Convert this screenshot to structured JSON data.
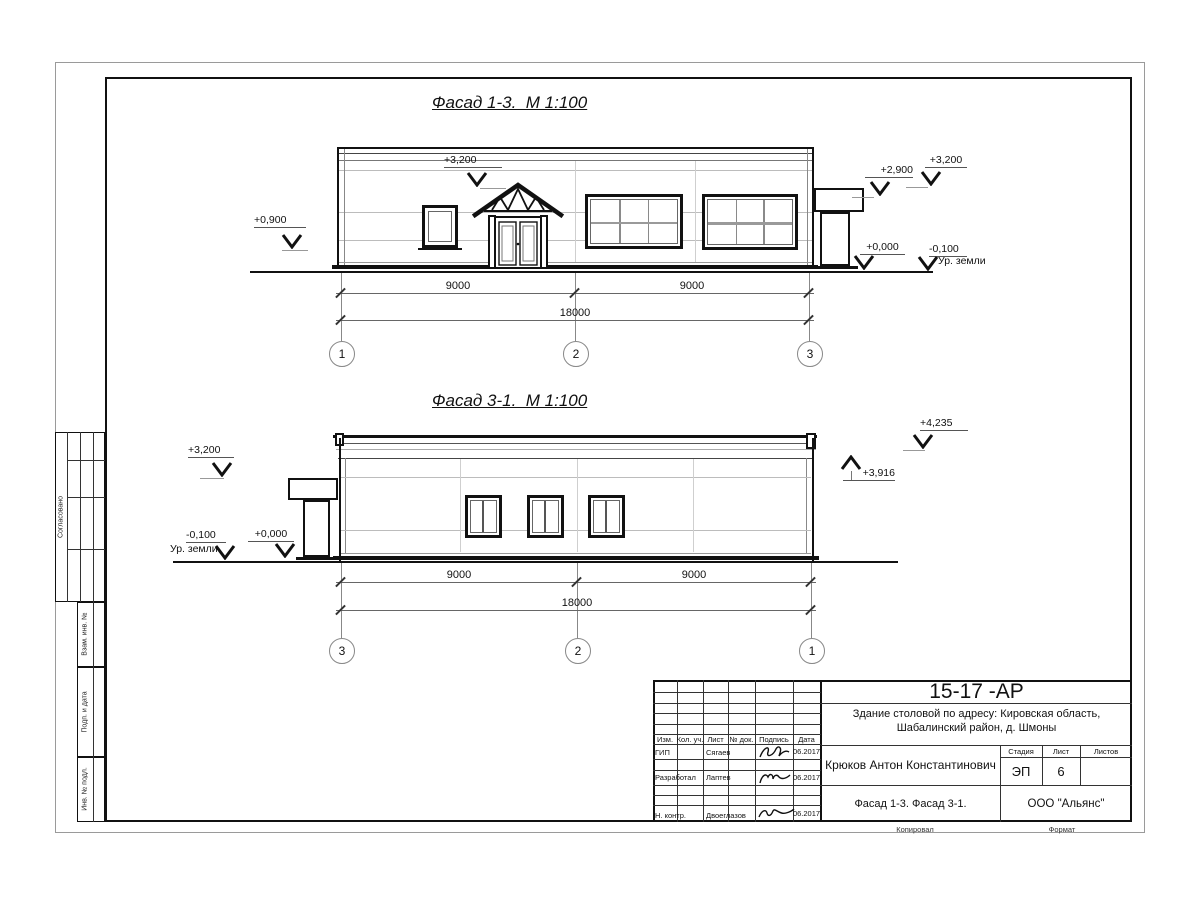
{
  "drawing1": {
    "title": "Фасад 1-3.  М 1:100",
    "marks": {
      "roof": "+3,200",
      "left_wall": "+0,900",
      "canopy": "+2,900",
      "right": "+3,200",
      "zero": "+0,000",
      "ground": "-0,100",
      "ground_label": "Ур. земли"
    },
    "dims": {
      "span1": "9000",
      "span2": "9000",
      "total": "18000"
    },
    "axes": [
      "1",
      "2",
      "3"
    ]
  },
  "drawing2": {
    "title": "Фасад 3-1.  М 1:100",
    "marks": {
      "canopy": "+3,200",
      "ground": "-0,100",
      "ground_label": "Ур. земли",
      "zero": "+0,000",
      "parapet": "+3,916",
      "top": "+4,235"
    },
    "dims": {
      "span1": "9000",
      "span2": "9000",
      "total": "18000"
    },
    "axes": [
      "3",
      "2",
      "1"
    ]
  },
  "titleblock": {
    "doc_number": "15-17 -АР",
    "object_line1": "Здание столовой по адресу: Кировская область,",
    "object_line2": "Шабалинский район, д. Шмоны",
    "chief": "Крюков Антон Константинович",
    "sheet_name": "Фасад 1-3. Фасад 3-1.",
    "company": "ООО \"Альянс\"",
    "cols": {
      "izm": "Изм.",
      "kol": "Кол. уч.",
      "list": "Лист",
      "doc": "№ док.",
      "sign": "Подпись",
      "date": "Дата"
    },
    "stage_col": {
      "label": "Стадия",
      "value": "ЭП"
    },
    "list_col": {
      "label": "Лист",
      "value": "6"
    },
    "listov_col": {
      "label": "Листов",
      "value": ""
    },
    "rows": [
      {
        "role": "ГИП",
        "name": "Сягаев",
        "date": "06.2017"
      },
      {
        "role": "Разработал",
        "name": "Лаптев",
        "date": "06.2017"
      },
      {
        "role": "Н. контр.",
        "name": "Двоеглазов",
        "date": "06.2017"
      }
    ],
    "copied": "Копировал",
    "format": "Формат"
  },
  "frame_labels": {
    "approved": "Согласовано",
    "replace_inv": "Взам. инв. №",
    "sign_date": "Подп. и дата",
    "inv_orig": "Инв. № подл."
  }
}
